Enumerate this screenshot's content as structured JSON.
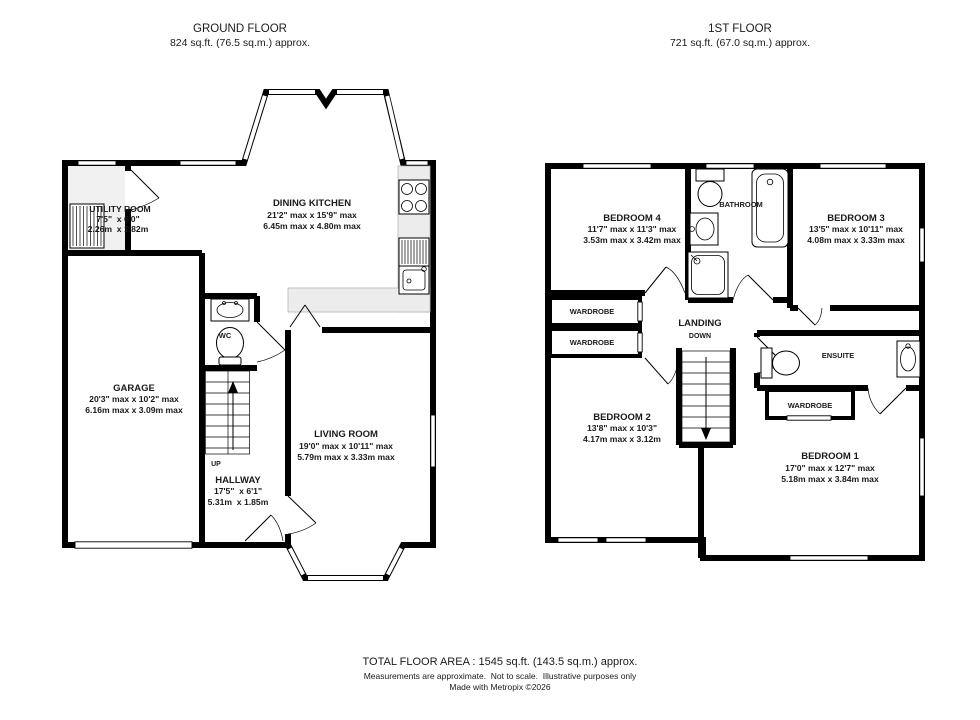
{
  "ground_floor": {
    "title": "GROUND FLOOR",
    "area": "824 sq.ft. (76.5 sq.m.) approx.",
    "stairs_label": "UP",
    "rooms": {
      "dining_kitchen": {
        "name": "DINING KITCHEN",
        "dims_imperial": "21'2\" max x 15'9\" max",
        "dims_metric": "6.45m max x 4.80m max"
      },
      "utility_room": {
        "name": "UTILITY ROOM",
        "dims_imperial": "7'5\"  x 6'0\"",
        "dims_metric": "2.26m  x 1.82m"
      },
      "garage": {
        "name": "GARAGE",
        "dims_imperial": "20'3\" max x 10'2\" max",
        "dims_metric": "6.16m max x 3.09m max"
      },
      "living_room": {
        "name": "LIVING ROOM",
        "dims_imperial": "19'0\" max x 10'11\" max",
        "dims_metric": "5.79m max x 3.33m max"
      },
      "hallway": {
        "name": "HALLWAY",
        "dims_imperial": "17'5\"  x 6'1\"",
        "dims_metric": "5.31m  x 1.85m"
      },
      "wc": {
        "name": "WC"
      }
    }
  },
  "first_floor": {
    "title": "1ST FLOOR",
    "area": "721 sq.ft. (67.0 sq.m.) approx.",
    "stairs_label": "DOWN",
    "rooms": {
      "bedroom_1": {
        "name": "BEDROOM 1",
        "dims_imperial": "17'0\" max x 12'7\" max",
        "dims_metric": "5.18m max x 3.84m max"
      },
      "bedroom_2": {
        "name": "BEDROOM 2",
        "dims_imperial": "13'8\" max x 10'3\"",
        "dims_metric": "4.17m max x 3.12m"
      },
      "bedroom_3": {
        "name": "BEDROOM 3",
        "dims_imperial": "13'5\" max x 10'11\" max",
        "dims_metric": "4.08m max x 3.33m max"
      },
      "bedroom_4": {
        "name": "BEDROOM 4",
        "dims_imperial": "11'7\" max x 11'3\" max",
        "dims_metric": "3.53m max x 3.42m max"
      },
      "bathroom": {
        "name": "BATHROOM"
      },
      "ensuite": {
        "name": "ENSUITE"
      },
      "landing": {
        "name": "LANDING"
      },
      "wardrobe_1": {
        "name": "WARDROBE"
      },
      "wardrobe_2": {
        "name": "WARDROBE"
      },
      "wardrobe_3": {
        "name": "WARDROBE"
      }
    }
  },
  "footer": {
    "total_area": "TOTAL FLOOR AREA : 1545 sq.ft. (143.5 sq.m.) approx.",
    "disclaimer": "Measurements are approximate.  Not to scale.  Illustrative purposes only",
    "credit": "Made with Metropix ©2026"
  },
  "colors": {
    "wall": "#000000",
    "floor": "#ffffff",
    "counter": "#ececec"
  }
}
